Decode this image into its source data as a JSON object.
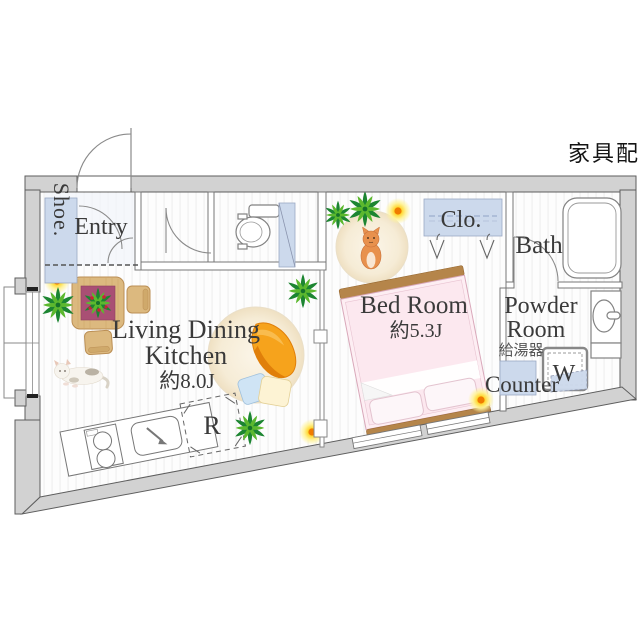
{
  "title": {
    "note": "家具配置例"
  },
  "rooms": {
    "shoe": {
      "label": "Shoe."
    },
    "entry": {
      "label": "Entry"
    },
    "ldk": {
      "line1": "Living Dining",
      "line2": "Kitchen",
      "size": "約8.0J"
    },
    "bedroom": {
      "label": "Bed Room",
      "size": "約5.3J"
    },
    "closet": {
      "label": "Clo."
    },
    "bath": {
      "label": "Bath"
    },
    "powder": {
      "line1": "Powder",
      "line2": "Room"
    },
    "water_heater": {
      "label": "給湯器"
    },
    "washer": {
      "label": "W"
    },
    "counter": {
      "label": "Counter"
    },
    "refrigerator": {
      "label": "R"
    }
  },
  "colors": {
    "wall": "#d2d2d2",
    "wall_line": "#5e5e5e",
    "fixture_blue": "#ccd9ec",
    "bed_pink": "#fdeef3",
    "bed_frame": "#b5854a",
    "wood": "#dcb97f",
    "tablecloth": "#a94f74",
    "beanbag_orange": "#f6a31c",
    "plant_green": "#2e9e3e",
    "sun_yellow": "#ffd832",
    "label_gray": "#3a3a3a"
  }
}
